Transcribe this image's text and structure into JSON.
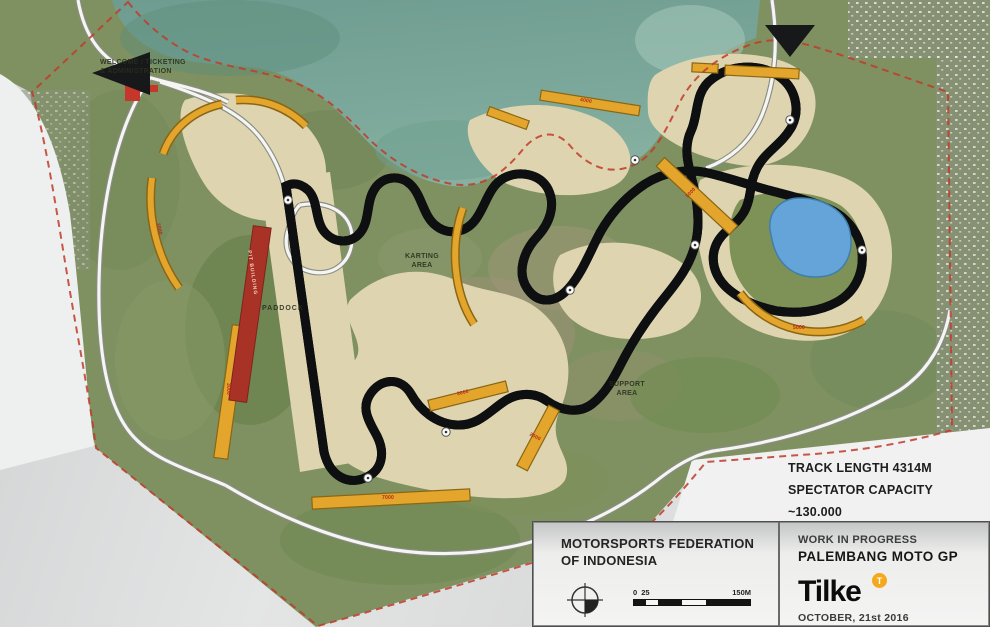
{
  "map": {
    "facility_labels": {
      "welcome": "WELCOME / TICKETING\n& ADMINISTRATION",
      "karting": "KARTING\nAREA",
      "paddock": "PADDOCK",
      "support": "SUPPORT\nAREA",
      "pit_building": "PIT BUILDING"
    },
    "stats": {
      "track_length": "TRACK LENGTH 4314M",
      "spectator_capacity": "SPECTATOR CAPACITY ~130.000"
    },
    "grandstands": [
      {
        "capacity": "7000"
      },
      {
        "capacity": "5000"
      },
      {
        "capacity": "5000"
      },
      {
        "capacity": "4000"
      },
      {
        "capacity": "3000"
      },
      {
        "capacity": "3000"
      },
      {
        "capacity": "2000"
      },
      {
        "capacity": "2000"
      }
    ]
  },
  "title_block": {
    "organization": "MOTORSPORTS FEDERATION\nOF INDONESIA",
    "status": "WORK IN PROGRESS",
    "project": "PALEMBANG MOTO GP",
    "logo": {
      "text": "Tilke",
      "badge": "T"
    },
    "date": "OCTOBER, 21st 2016",
    "scale_bar": {
      "zero": "0",
      "mid": "25",
      "max": "150M"
    }
  },
  "colors": {
    "grandstand_yellow": "#E3A52C",
    "boundary_red": "#C03B2B",
    "water_teal": "#79A398",
    "pond_blue": "#64A4D8",
    "pit_red": "#A93226",
    "logo_orange": "#F5A81C"
  }
}
